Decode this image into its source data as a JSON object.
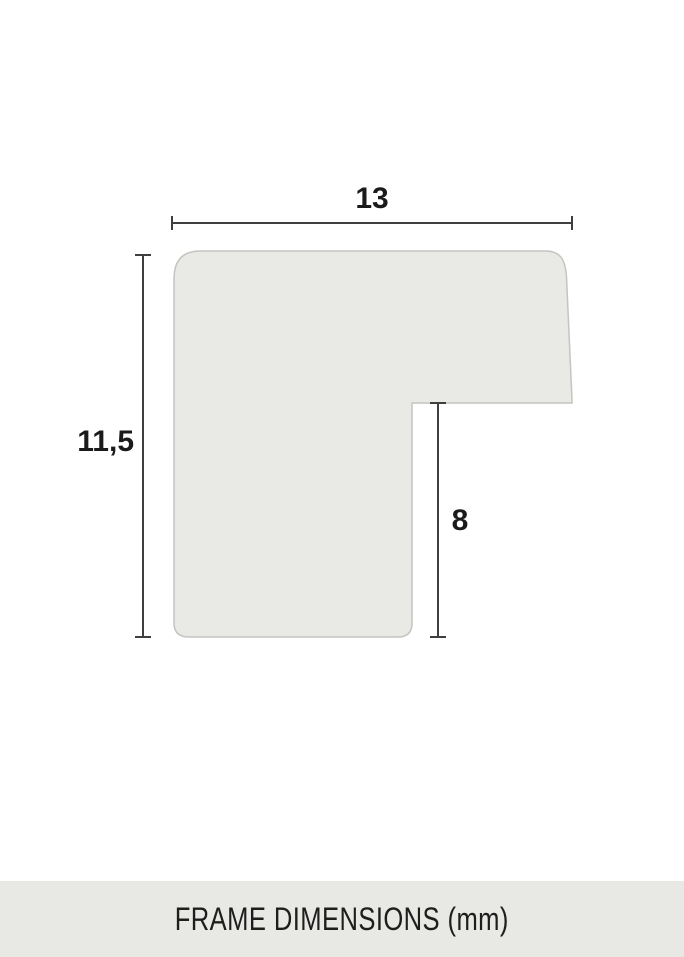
{
  "diagram": {
    "type": "frame-profile-cross-section",
    "dimensions": {
      "width": {
        "label": "13",
        "value": 13
      },
      "height": {
        "label": "11,5",
        "value": 11.5
      },
      "depth": {
        "label": "8",
        "value": 8
      }
    }
  },
  "footer": {
    "caption": "FRAME DIMENSIONS (mm)",
    "unit": "mm"
  },
  "colors": {
    "background": "#ffffff",
    "shape_fill": "#e9e9e5",
    "shape_stroke": "#c4c4c0",
    "dimension_line": "#3f3f3f",
    "label_text": "#1b1b1b",
    "footer_bg": "#e8e8e4",
    "footer_text": "#1e1e1e"
  }
}
